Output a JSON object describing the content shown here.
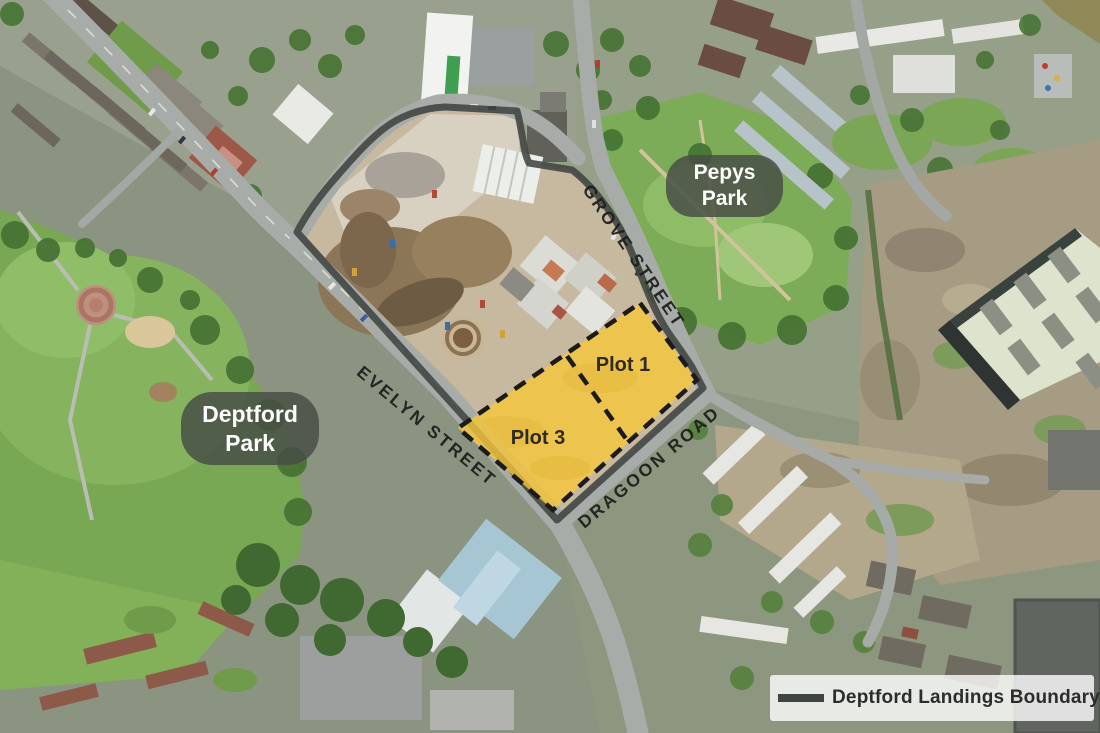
{
  "map": {
    "street_labels": [
      {
        "id": "grove-street",
        "text": "GROVE STREET"
      },
      {
        "id": "evelyn-street",
        "text": "EVELYN STREET"
      },
      {
        "id": "dragoon-road",
        "text": "DRAGOON ROAD"
      }
    ],
    "plot_labels": [
      {
        "text": "Plot 1"
      },
      {
        "text": "Plot 3"
      }
    ],
    "park_badges": [
      {
        "line1": "Pepys",
        "line2": "Park"
      },
      {
        "line1": "Deptford",
        "line2": "Park"
      }
    ],
    "legend": {
      "label": "Deptford Landings Boundary"
    },
    "colors": {
      "plot_fill": "#f6c73a",
      "plot_dash": "#1b1b1b",
      "boundary_line": "#3e4440",
      "badge_bg": "rgba(72,78,69,0.84)",
      "legend_bg": "rgba(255,255,255,0.8)",
      "street_label": "#1e1e1e"
    }
  }
}
